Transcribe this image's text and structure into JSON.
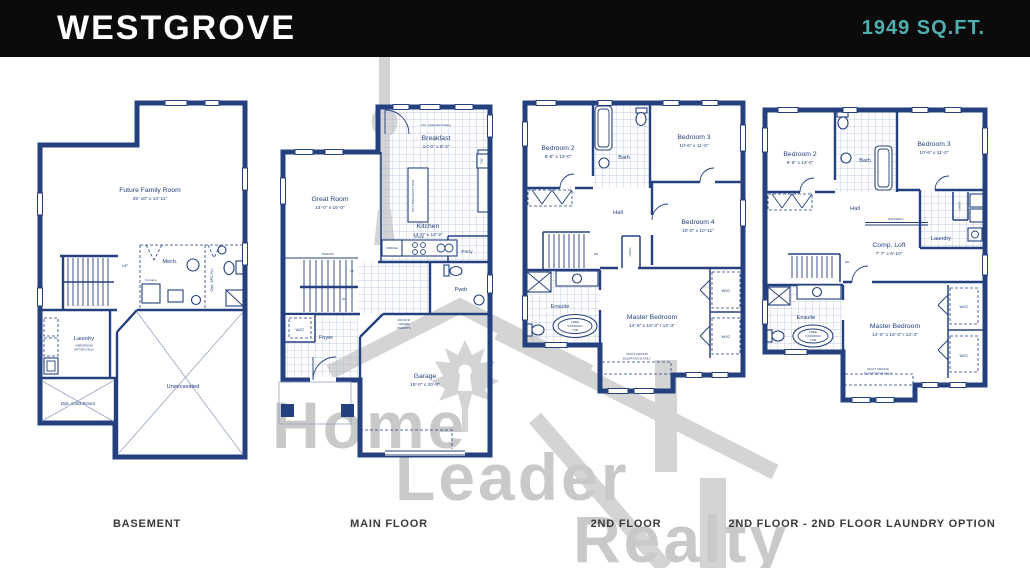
{
  "header": {
    "title": "WESTGROVE",
    "sqft": "1949 SQ.FT."
  },
  "watermark": {
    "word1": "Home",
    "word2": "Leader",
    "word3": "Realty"
  },
  "captions": {
    "basement": "BASEMENT",
    "main_floor": "MAIN FLOOR",
    "second_floor": "2ND FLOOR",
    "laundry_option": "2ND FLOOR - 2ND FLOOR LAUNDRY OPTION"
  },
  "basement": {
    "family_room": "Future Family Room",
    "family_room_dims": "25'-10\" x 14'-11\"",
    "mech": "Mech.",
    "furnace": "Furnace",
    "opt_3pc": "Opt. 3PC R-I",
    "up": "UP",
    "laundry": "Laundry",
    "laundry_note1": "4 BEDROOM",
    "laundry_note2": "OPTION ONLY",
    "unexcavated": "Unexcavated",
    "cold_room": "Opt. Cold Room"
  },
  "main_floor": {
    "cathedral": "Opt. Cathedral Ceiling",
    "breakfast": "Breakfast",
    "breakfast_dims": "14'-0\" x 9'-3\"",
    "great_room": "Great Room",
    "great_room_dims": "14'-0\" x 15'-0\"",
    "kitchen": "Kitchen",
    "kitchen_dims": "14'-0\" x 12'-2\"",
    "island": "OPT. BREAKFAST BAR",
    "fridge": "FRIDGE",
    "stove": "STOVE",
    "dw": "DW",
    "pantry": "Pntry",
    "powder": "Pwdr",
    "railing": "RAILING",
    "up": "UP",
    "dn": "DN",
    "wic": "W/IC",
    "foyer": "Foyer",
    "garage": "Garage",
    "garage_dims": "18'-0\" x 20'-0\"",
    "door_note1": "DOOR IF",
    "door_note2": "GRADE",
    "door_note3": "PERMITS"
  },
  "second_floor": {
    "bedroom2": "Bedroom 2",
    "bedroom2_dims": "9'-5\" x 13'-0\"",
    "bath": "Bath",
    "bedroom3": "Bedroom 3",
    "bedroom3_dims": "10'-6\" x 11'-0\"",
    "bedroom4": "Bedroom 4",
    "bedroom4_dims": "10'-0\" x 10'-11\"",
    "hall": "Hall",
    "dn": "DN",
    "linen": "LINEN",
    "ensuite": "Ensuite",
    "tub1": "FREE",
    "tub2": "STANDING",
    "tub3": "TUB",
    "master": "Master Bedroom",
    "master_dims": "14'-6\" x 16'-3\" / 14'-3\"",
    "wic": "W/IC",
    "vault1": "VAULT CEILING",
    "vault2": "ELEVATION B ONLY"
  },
  "laundry_option": {
    "bedroom2": "Bedroom 2",
    "bedroom2_dims": "9'-5\" x 13'-0\"",
    "bath": "Bath",
    "bedroom3": "Bedroom 3",
    "bedroom3_dims": "10'-6\" x 11'-0\"",
    "hall": "Hall",
    "halfwall": "HALFWALL",
    "laundry": "Laundry",
    "linen": "LINEN",
    "comp_loft": "Comp. Loft",
    "comp_loft_dims": "7'-7\" x 6'-10\"",
    "dn": "DN",
    "ensuite": "Ensuite",
    "tub1": "FREE",
    "tub2": "STANDING",
    "tub3": "TUB",
    "master": "Master Bedroom",
    "master_dims": "14'-6\" x 16'-3\" / 14'-3\"",
    "wic": "W/IC",
    "vault1": "VAULT CEILING",
    "vault2": "ELEVATION B ONLY"
  }
}
